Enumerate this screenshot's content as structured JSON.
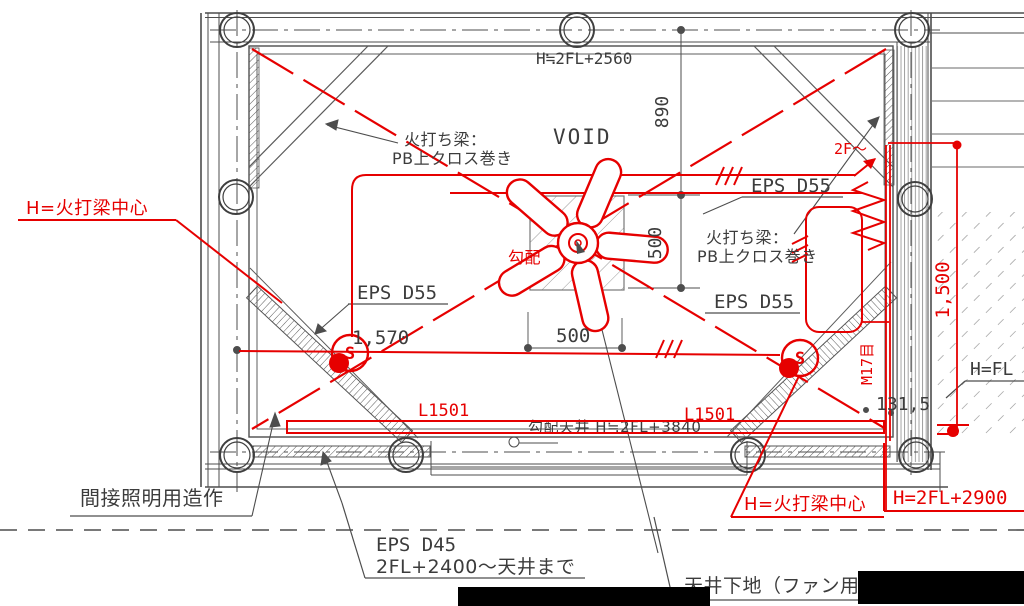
{
  "title": "ceiling-plan-markup-drawing",
  "colors": {
    "markup_red": "#e60000",
    "line_gray": "#4d4d4d",
    "text_gray": "#3c3c3c"
  },
  "labels": {
    "height_top": "H≒2FL+2560",
    "void": "VOID",
    "brace_top_1": "火打ち梁：",
    "brace_top_2": "PB上クロス巻き",
    "brace_right_1": "火打ち梁：",
    "brace_right_2": "PB上クロス巻き",
    "eps_d55_left": "EPS D55",
    "eps_d55_right_upper": "EPS D55",
    "eps_d55_right_lower": "EPS D55",
    "slope": "勾配",
    "slope_ceiling": "勾配天井 H≒2FL+3840",
    "l1501_left": "L1501",
    "l1501_right": "L1501",
    "h_brace_center_left": "H=火打梁中心",
    "h_brace_center_right": "H=火打梁中心",
    "h_2fl_2900": "H=2FL+2900",
    "h_fl_partial": "H=FL",
    "to_2f": "2F～",
    "m17": "M17目",
    "s1": "S",
    "s2": "S",
    "indirect_lighting": "間接照明用造作",
    "eps_d45_1": "EPS D45",
    "eps_d45_2": "2FL+2400～天井まで",
    "ceiling_base_fan": "天井下地（ファン用）"
  },
  "dims": {
    "d890": "890",
    "d500_v": "500",
    "d500_h": "500",
    "d1570": "1,570",
    "d1500": "1,500",
    "d131_5": "131,5"
  }
}
